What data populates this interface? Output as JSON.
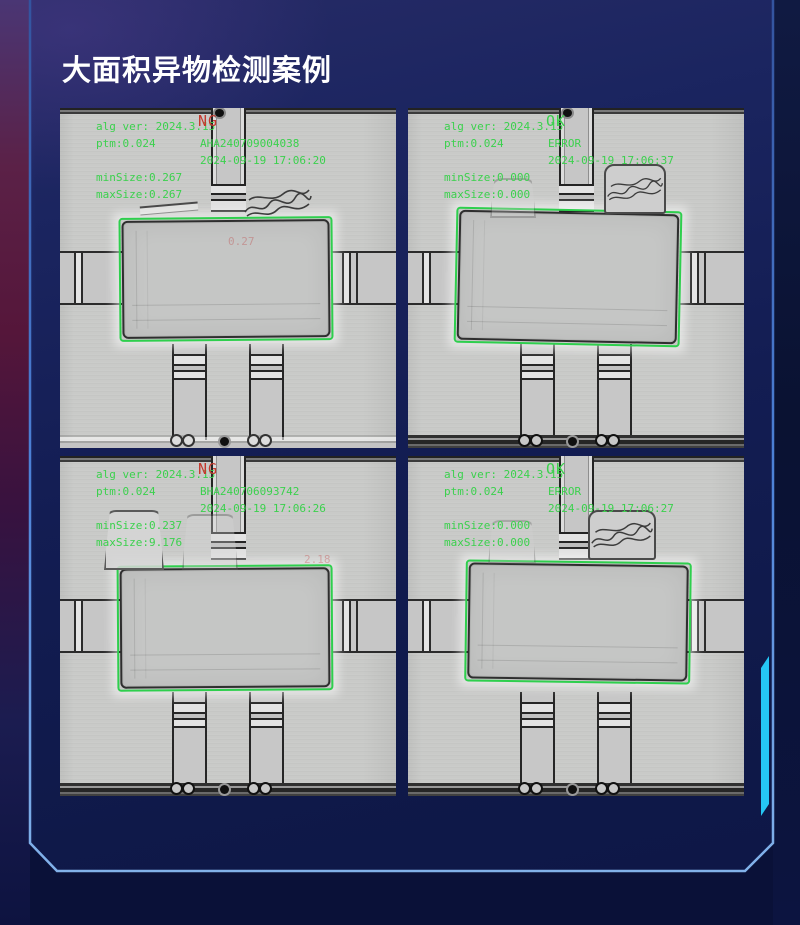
{
  "slide": {
    "title": "大面积异物检测案例"
  },
  "colors": {
    "overlay_green": "#3bd14d",
    "status_ng_red": "#c4392e",
    "detection_box_green": "#2ecf4d",
    "frame_blue": "#4d82d8",
    "accent_cyan": "#25c6f5",
    "panel_navy": "#131d53"
  },
  "cards": [
    {
      "name": "top-left",
      "alg_ver": "alg ver: 2024.3.15",
      "status": "NG",
      "ptm": "ptm:0.024",
      "code": "AHA240709004038",
      "datetime": "2024-09-19 17:06:20",
      "min_size": "minSize:0.267",
      "max_size": "maxSize:0.267",
      "faint_mark": "0.27"
    },
    {
      "name": "top-right",
      "alg_ver": "alg ver: 2024.3.15",
      "status": "OK",
      "ptm": "ptm:0.024",
      "code": "ERROR",
      "datetime": "2024-09-19 17:06:37",
      "min_size": "minSize:0.000",
      "max_size": "maxSize:0.000",
      "faint_mark": ""
    },
    {
      "name": "bottom-left",
      "alg_ver": "alg ver: 2024.3.15",
      "status": "NG",
      "ptm": "ptm:0.024",
      "code": "BHA240706093742",
      "datetime": "2024-09-19 17:06:26",
      "min_size": "minSize:0.237",
      "max_size": "maxSize:9.176",
      "faint_mark": "2.18"
    },
    {
      "name": "bottom-right",
      "alg_ver": "alg ver: 2024.3.15",
      "status": "OK",
      "ptm": "ptm:0.024",
      "code": "ERROR",
      "datetime": "2024-09-19 17:06:27",
      "min_size": "minSize:0.000",
      "max_size": "maxSize:0.000",
      "faint_mark": ""
    }
  ]
}
